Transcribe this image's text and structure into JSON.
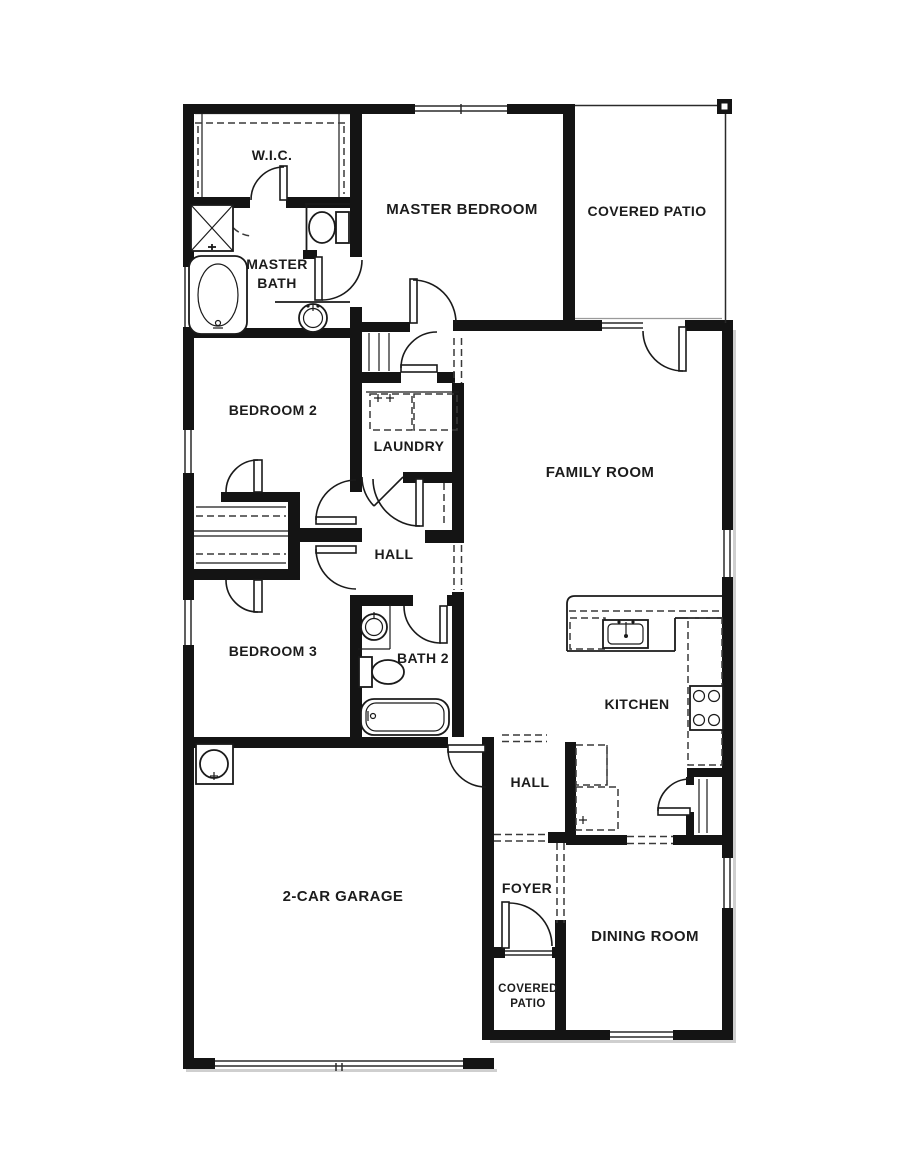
{
  "document": {
    "type": "single-story house floor plan",
    "colors": {
      "walls": "#141414",
      "lines": "#1a1a1a",
      "labels": "#1c1c1c",
      "background": "#ffffff"
    }
  },
  "labels": {
    "wic": "W.I.C.",
    "master_bath_line1": "MASTER",
    "master_bath_line2": "BATH",
    "master_bedroom": "MASTER BEDROOM",
    "covered_patio_rear": "COVERED PATIO",
    "bedroom2": "BEDROOM 2",
    "laundry": "LAUNDRY",
    "family_room": "FAMILY ROOM",
    "hall_bedroom_wing": "HALL",
    "bedroom3": "BEDROOM 3",
    "bath2": "BATH 2",
    "kitchen": "KITCHEN",
    "hall_rear": "HALL",
    "garage": "2-CAR GARAGE",
    "foyer": "FOYER",
    "covered_patio_front_line1": "COVERED",
    "covered_patio_front_line2": "PATIO",
    "dining_room": "DINING ROOM"
  }
}
